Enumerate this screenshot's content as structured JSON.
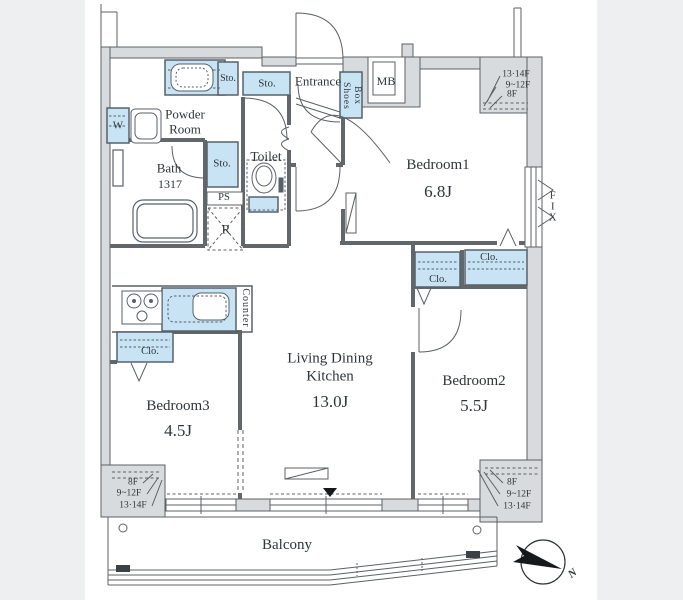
{
  "title": "Apartment floor plan",
  "rooms": {
    "bedroom1": {
      "name": "Bedroom1",
      "area": "6.8J"
    },
    "bedroom2": {
      "name": "Bedroom2",
      "area": "5.5J"
    },
    "bedroom3": {
      "name": "Bedroom3",
      "area": "4.5J"
    },
    "ldk": {
      "name": "Living Dining\nKitchen",
      "area": "13.0J"
    },
    "bath": {
      "name": "Bath",
      "size": "1317"
    },
    "powder_room": {
      "name": "Powder\nRoom"
    },
    "toilet": {
      "name": "Toilet"
    },
    "entrance": {
      "name": "Entrance"
    },
    "balcony": {
      "name": "Balcony"
    }
  },
  "fixtures": {
    "storage": "Sto.",
    "closet": "Clo.",
    "shoes_box": "Shoes\nBox",
    "washer": "W",
    "pipe_space": "PS",
    "refrigerator": "R",
    "meter_box": "MB",
    "counter": "Counter",
    "fix_window": "FIX"
  },
  "floor_levels": {
    "top_right": [
      "13·14F",
      "9~12F",
      "8F"
    ],
    "bottom_left": [
      "8F",
      "9~12F",
      "13·14F"
    ],
    "bottom_right": [
      "8F",
      "9~12F",
      "13·14F"
    ]
  },
  "compass": {
    "north_label": "N"
  },
  "colors": {
    "fixture_blue": "#c8e3f3",
    "wall_gray": "#d8dbde",
    "line": "#5c6165",
    "page_bg": "#eeeff0",
    "marker_black": "#16181a"
  }
}
